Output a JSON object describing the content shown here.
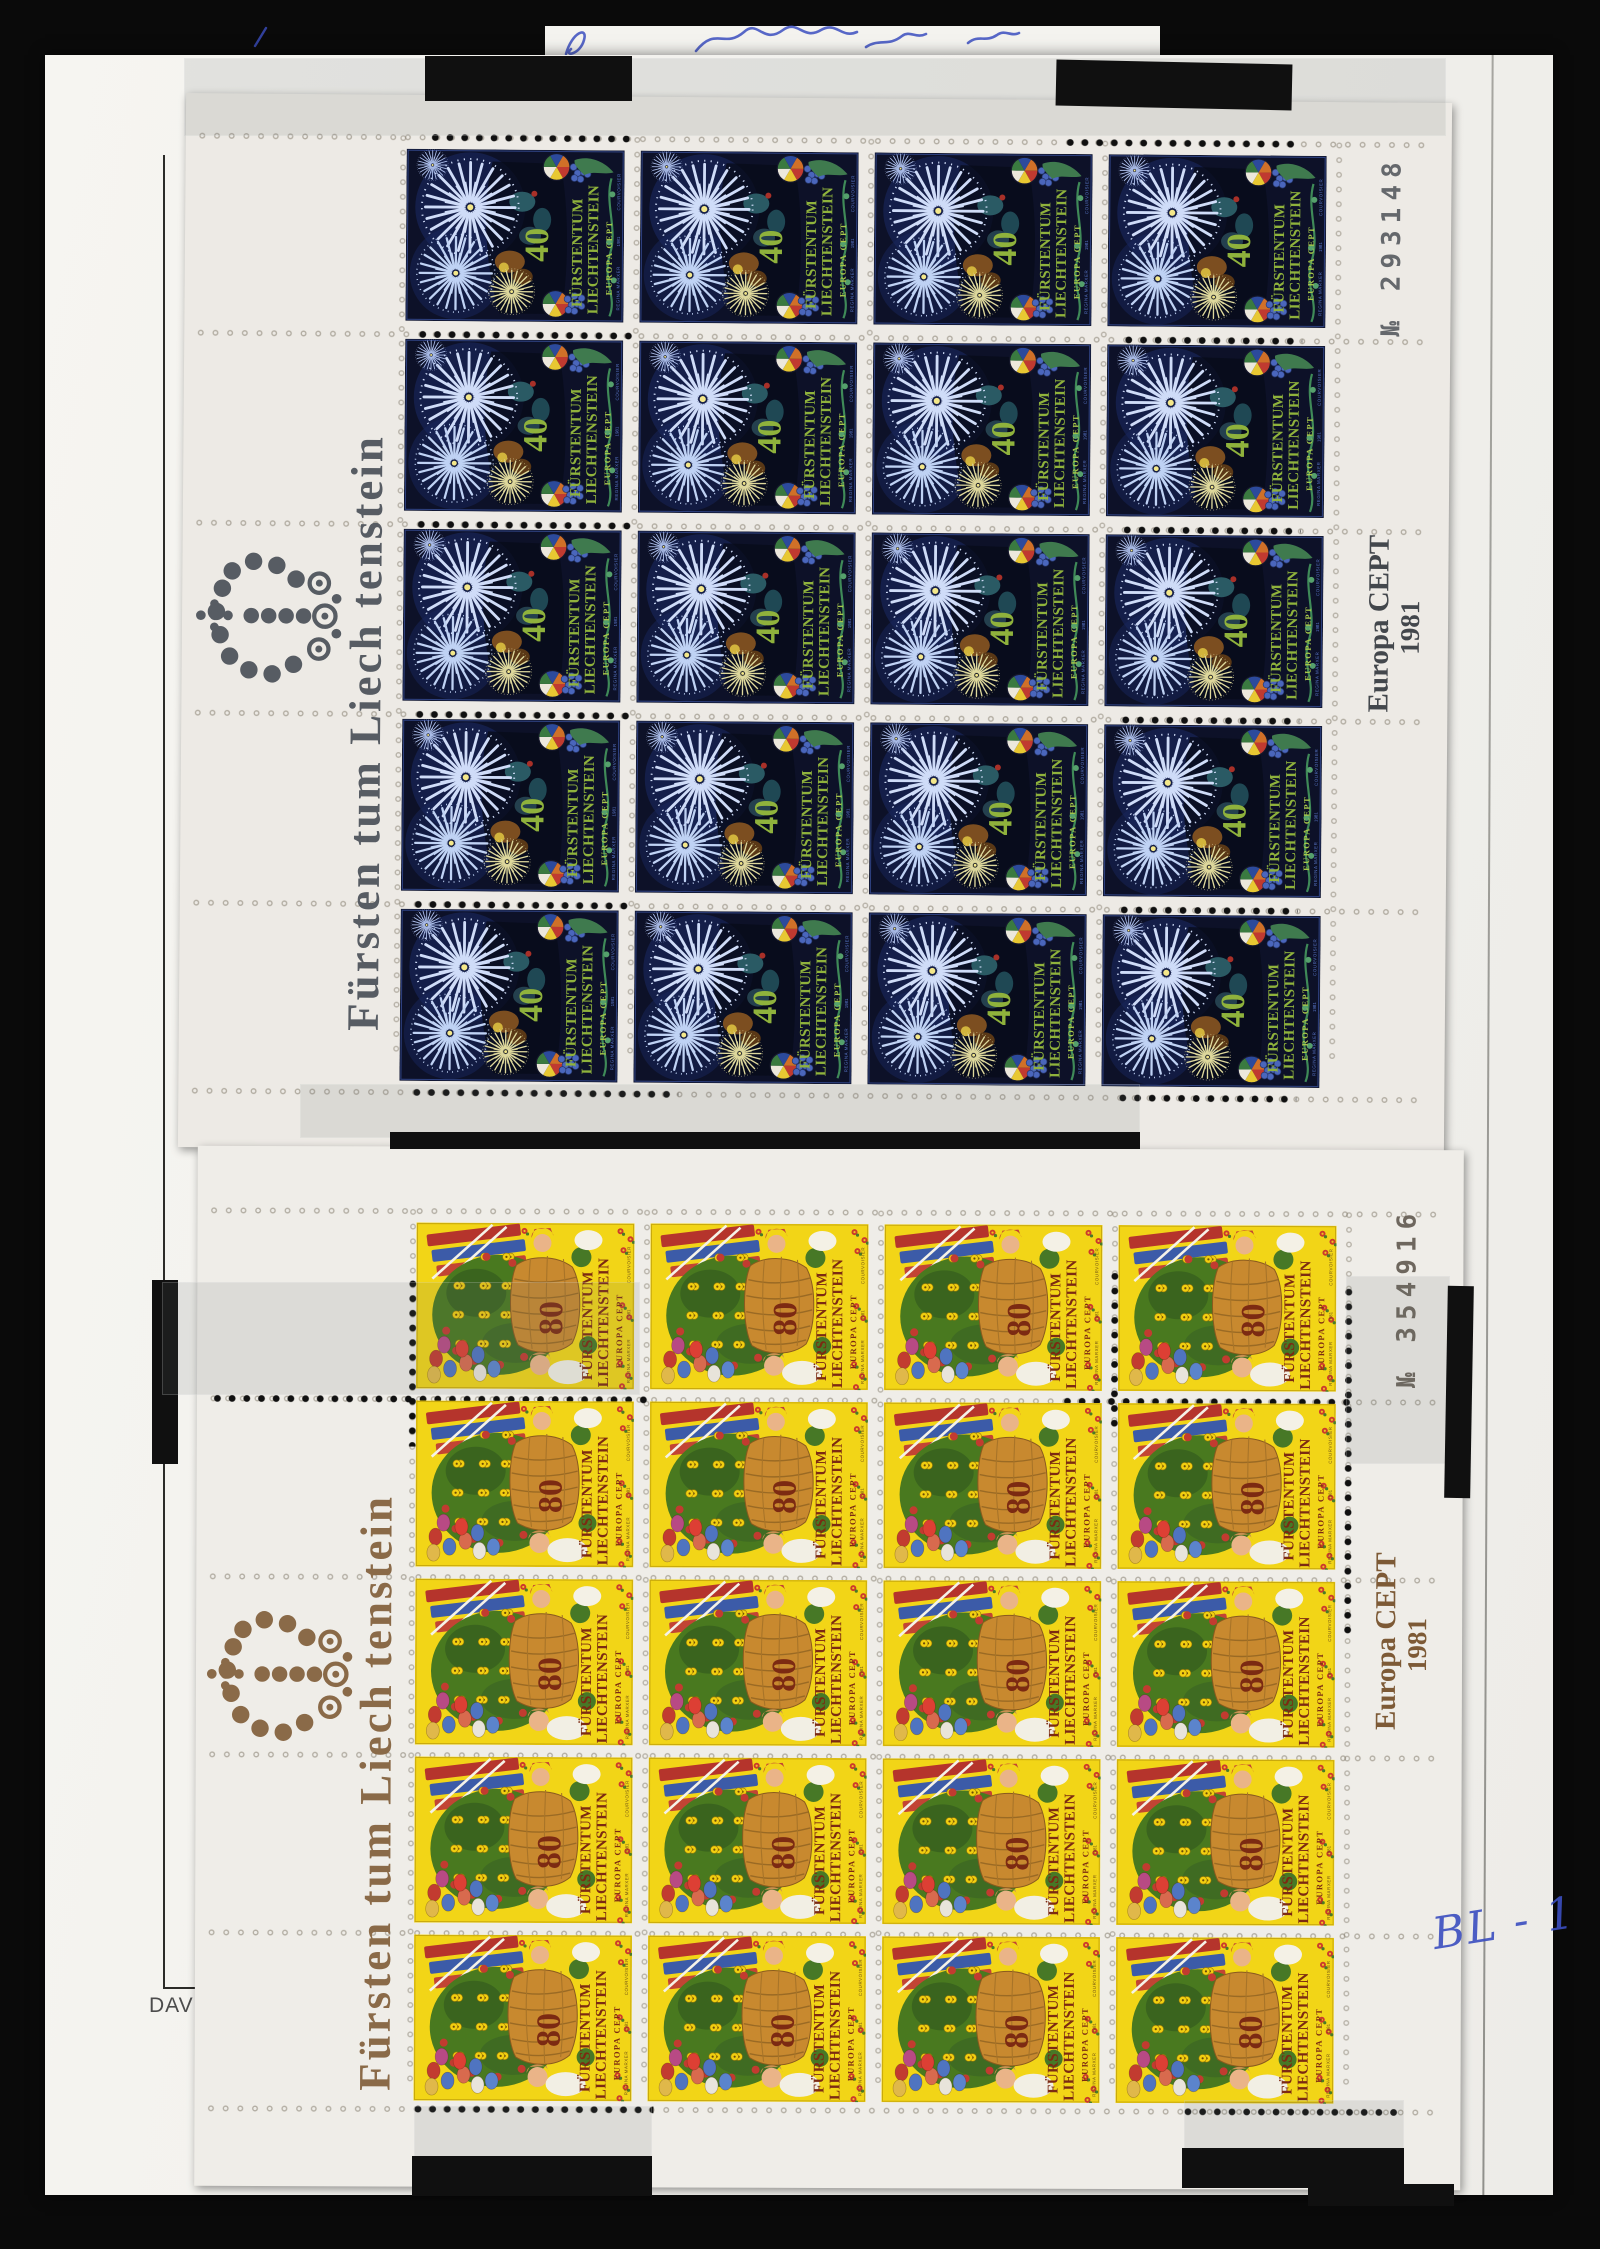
{
  "album_page": {
    "brand_text": "DAV",
    "handwriting_bottom_right": "BL - 1",
    "ink_color": "#3b4ec0"
  },
  "sheets": [
    {
      "name": "Liechtenstein Europa CEPT 1981 40 Rp sheet of 20",
      "position": "top",
      "rows": 5,
      "cols": 4,
      "margin_text": "Fürsten tum Liech tenstein",
      "sheet_number": "№ 293148",
      "inscription_line1": "Europa CEPT",
      "inscription_line2": "1981",
      "margin_colors": {
        "crown_and_text": "#575c63",
        "number": "#4e5257",
        "inscription": "#43474c"
      },
      "stamp": {
        "country_line1": "FÜRSTENTUM",
        "country_line2": "LIECHTENSTEIN",
        "series": "EUROPA CEPT",
        "denomination": "40",
        "designer": "REGINA MARXER",
        "year": "1981",
        "printer": "COURVOISIER",
        "theme": "fireworks, pinwheel and grapes on dark night blue",
        "colors": {
          "background": "#0d1128",
          "frame": "#2e4180",
          "text": "#8fb23c",
          "burst": "#cfdcf8",
          "burst_small": "#ded89c",
          "edge_text": "#5a78cc"
        }
      }
    },
    {
      "name": "Liechtenstein Europa CEPT 1981 80 Rp sheet of 20",
      "position": "bottom",
      "rows": 5,
      "cols": 4,
      "margin_text": "Fürsten tum Liech tenstein",
      "sheet_number": "№ 354916",
      "inscription_line1": "Europa CEPT",
      "inscription_line2": "1981",
      "margin_colors": {
        "crown_and_text": "#8a6a48",
        "number": "#585046",
        "inscription": "#7d5a36"
      },
      "stamp": {
        "country_line1": "FÜRSTENTUM",
        "country_line2": "LIECHTENSTEIN",
        "series": "EUROPA CEPT",
        "denomination": "80",
        "designer": "REGINA MARXER",
        "year": "1981",
        "printer": "COURVOISIER",
        "theme": "basket of flowers, children, flags and eggs on yellow",
        "colors": {
          "background": "#f2d517",
          "frame": "#c9a90c",
          "text": "#7c2a12",
          "basket": "#c8892f",
          "foliage": "#49791f",
          "edge_text": "#6a4a14"
        }
      }
    }
  ]
}
